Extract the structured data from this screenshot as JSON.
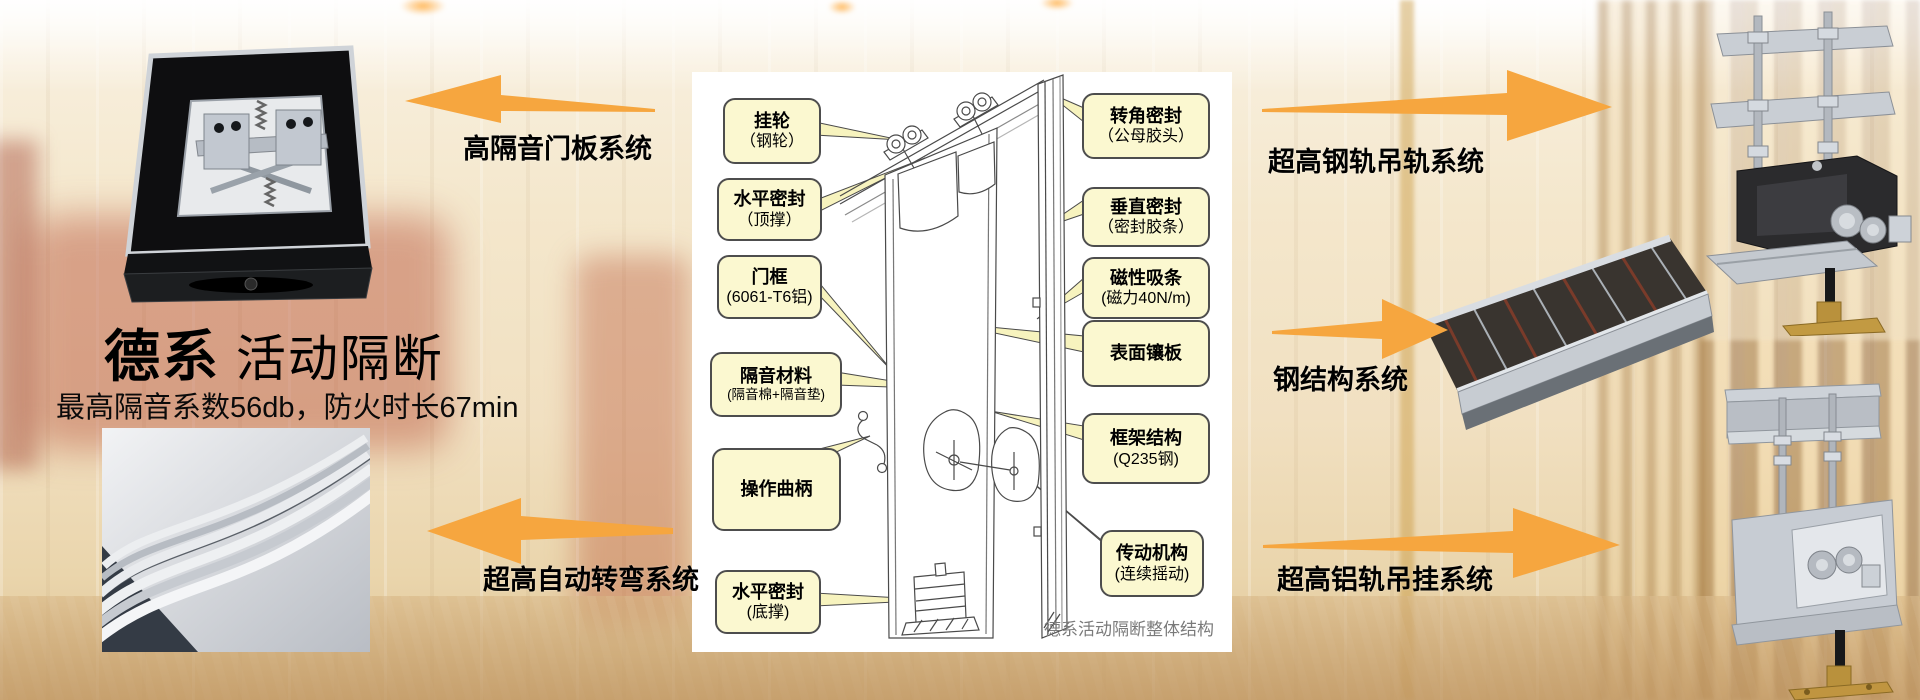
{
  "header": {
    "title_bold": "德系",
    "title_regular": " 活动隔断",
    "subtitle": "最高隔音系数56db，防火时长67min"
  },
  "systems": {
    "top_left": "高隔音门板系统",
    "bottom_left": "超高自动转弯系统",
    "top_right": "超高钢轨吊轨系统",
    "mid_right": "钢结构系统",
    "bottom_right": "超高铝轨吊挂系统"
  },
  "diagram": {
    "caption": "德系活动隔断整体结构",
    "left_callouts": [
      {
        "line1": "挂轮",
        "line2": "（钢轮）"
      },
      {
        "line1": "水平密封",
        "line2": "（顶撑）"
      },
      {
        "line1": "门框",
        "line2": "(6061-T6铝)"
      },
      {
        "line1": "隔音材料",
        "line2": "(隔音棉+隔音垫)"
      },
      {
        "line1": "操作曲柄",
        "line2": ""
      },
      {
        "line1": "水平密封",
        "line2": "(底撑)"
      }
    ],
    "right_callouts": [
      {
        "line1": "转角密封",
        "line2": "（公母胶头）"
      },
      {
        "line1": "垂直密封",
        "line2": "（密封胶条）"
      },
      {
        "line1": "磁性吸条",
        "line2": "(磁力40N/m)"
      },
      {
        "line1": "表面镶板",
        "line2": ""
      },
      {
        "line1": "框架结构",
        "line2": "(Q235钢)"
      },
      {
        "line1": "传动机构",
        "line2": "(连续摇动)"
      }
    ]
  },
  "colors": {
    "arrow_orange": "#F6A63F",
    "callout_fill": "#FBF8D0",
    "callout_border": "#4D4D4D",
    "caption_gray": "#7A7A7A",
    "text_black": "#000000"
  }
}
